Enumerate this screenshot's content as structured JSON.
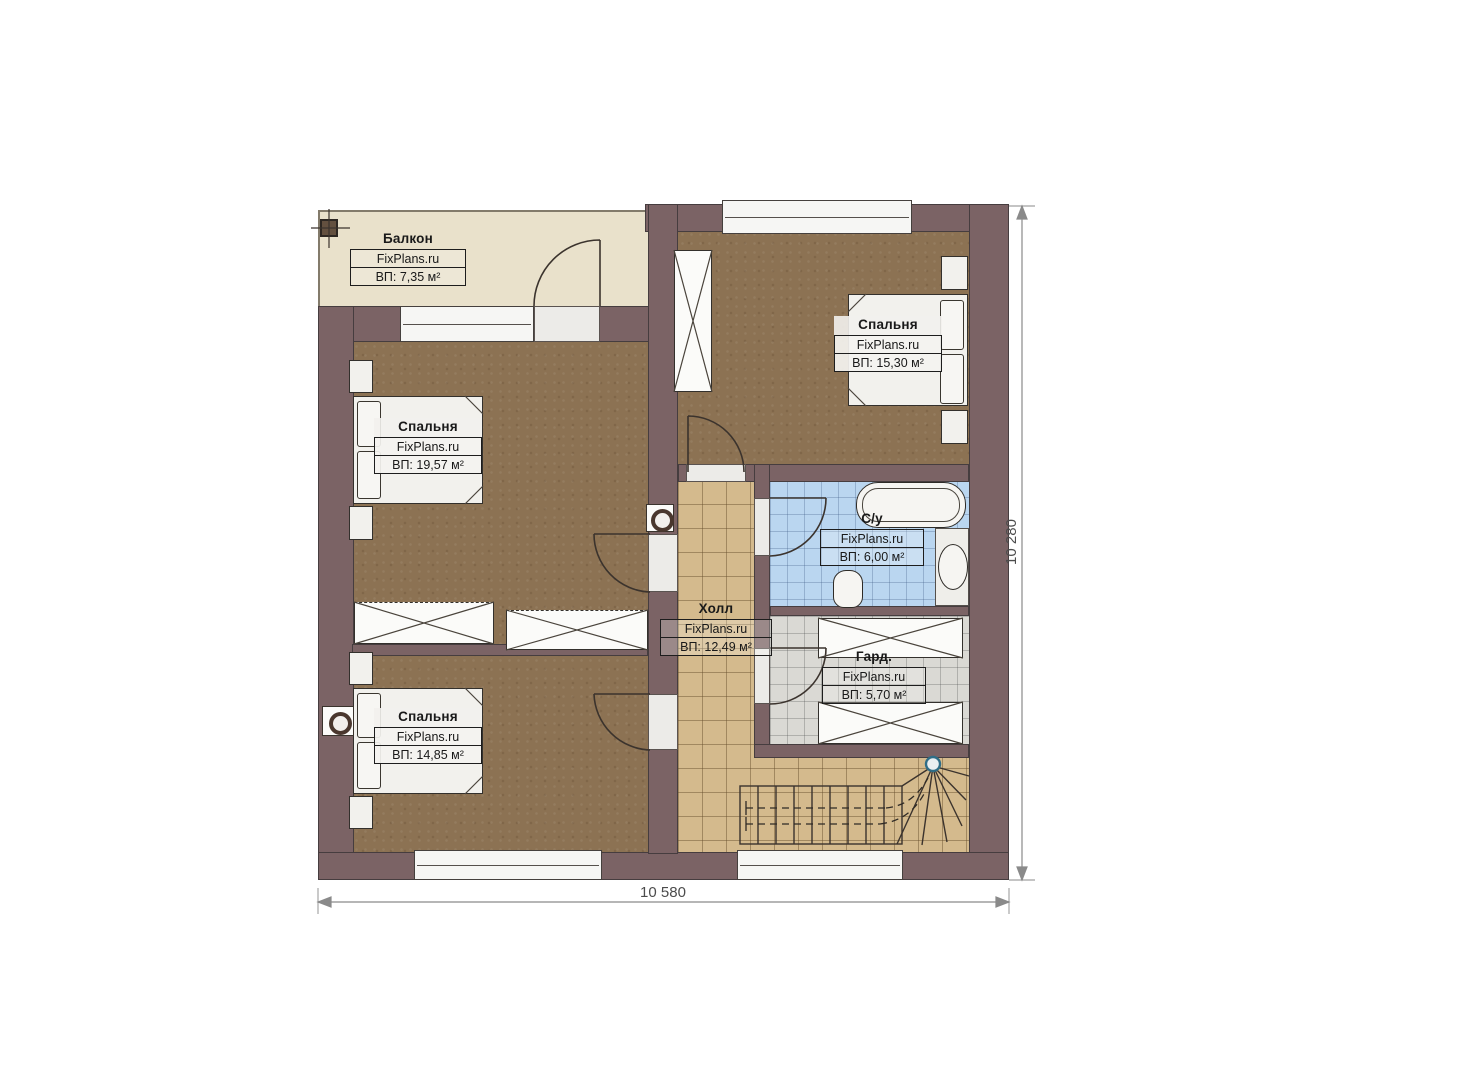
{
  "plan_title": "Floor plan — second level",
  "brand": "FixPlans.ru",
  "rooms": [
    {
      "id": "balcony",
      "name": "Балкон",
      "brand": "FixPlans.ru",
      "area": "ВП: 7,35 м²"
    },
    {
      "id": "bedroom-topleft",
      "name": "Спальня",
      "brand": "FixPlans.ru",
      "area": "ВП: 19,57 м²"
    },
    {
      "id": "bedroom-topright",
      "name": "Спальня",
      "brand": "FixPlans.ru",
      "area": "ВП: 15,30 м²"
    },
    {
      "id": "bedroom-bottomleft",
      "name": "Спальня",
      "brand": "FixPlans.ru",
      "area": "ВП: 14,85 м²"
    },
    {
      "id": "hall",
      "name": "Холл",
      "brand": "FixPlans.ru",
      "area": "ВП: 12,49 м²"
    },
    {
      "id": "bathroom",
      "name": "С/у",
      "brand": "FixPlans.ru",
      "area": "ВП: 6,00 м²"
    },
    {
      "id": "wardrobe",
      "name": "Гард.",
      "brand": "FixPlans.ru",
      "area": "ВП: 5,70 м²"
    }
  ],
  "dimensions": {
    "width_label": "10 580",
    "height_label": "10 280"
  },
  "colors": {
    "wall": "#7b6365",
    "bedroom_floor": "#8c7253",
    "balcony_floor": "#e9e1cb",
    "hall_floor": "#d4ba8d",
    "bathroom_floor": "#bad6f0",
    "wardrobe_floor": "#dad9d4"
  }
}
